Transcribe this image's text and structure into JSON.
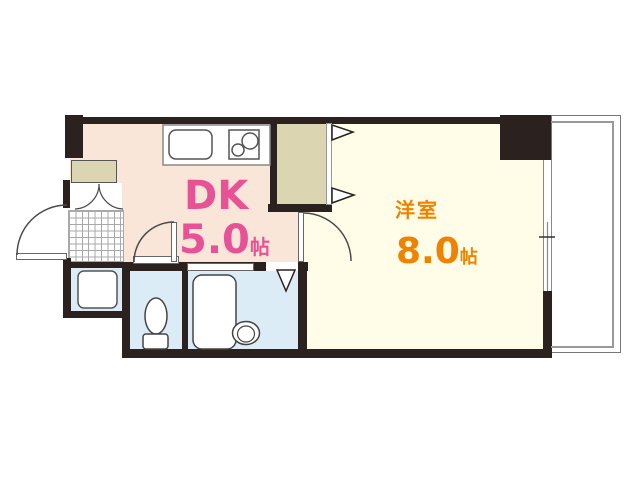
{
  "floor_plan": {
    "type": "apartment-floor-plan",
    "rooms": [
      {
        "id": "dk",
        "label": "DK",
        "size": "5.0",
        "unit": "帖",
        "floor_color": "#fae6d8",
        "label_color": "#e75297"
      },
      {
        "id": "western-room",
        "label": "洋室",
        "size": "8.0",
        "unit": "帖",
        "floor_color": "#fffce8",
        "label_color": "#ef8300"
      }
    ],
    "palette": {
      "wall": "#2b211e",
      "closet": "#dcd5b2",
      "wet_area": "#dcecf7",
      "tile_line": "#a9a9a9",
      "fixture_outline": "#4a4a4a",
      "background": "#ffffff"
    },
    "fixtures": [
      "entrance-door",
      "shoe-cabinet",
      "genkan-tile",
      "kitchen-sink",
      "gas-stove",
      "kitchen-counter",
      "closet",
      "washing-machine-pan",
      "toilet",
      "bathtub",
      "wash-basin",
      "sliding-window",
      "balcony"
    ]
  }
}
